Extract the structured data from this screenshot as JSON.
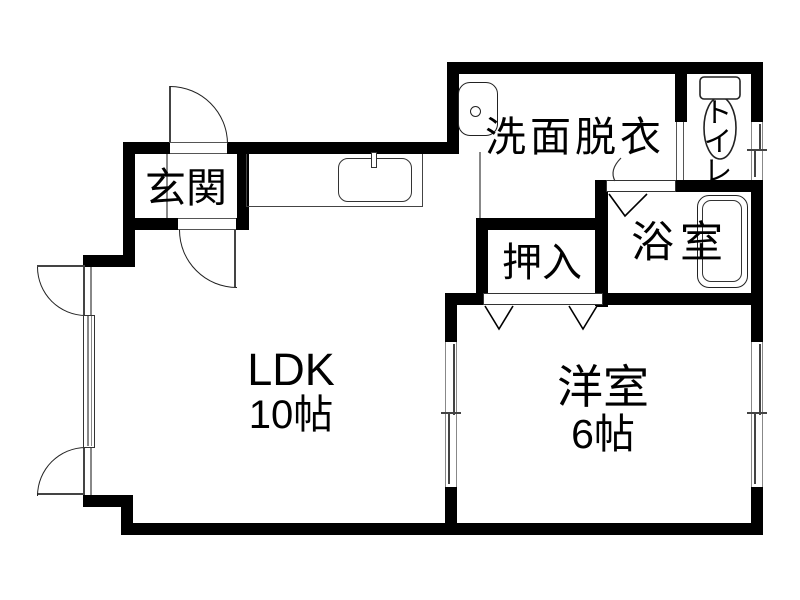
{
  "plan": {
    "rooms": {
      "genkan": {
        "label": "玄関"
      },
      "ldk": {
        "label": "LDK",
        "size": "10帖"
      },
      "washroom": {
        "label": "洗面脱衣"
      },
      "toilet": {
        "label": "トイレ"
      },
      "bathroom": {
        "label": "浴室"
      },
      "closet": {
        "label": "押入"
      },
      "western_room": {
        "label": "洋室",
        "size": "6帖"
      }
    },
    "fixtures": {
      "kitchen_sink": "kitchen-sink",
      "washbasin": "washbasin",
      "toilet_bowl": "toilet-bowl",
      "bathtub": "bathtub"
    },
    "colors": {
      "wall": "#000000",
      "thin_line": "#444444",
      "background": "#ffffff",
      "text": "#000000"
    }
  }
}
